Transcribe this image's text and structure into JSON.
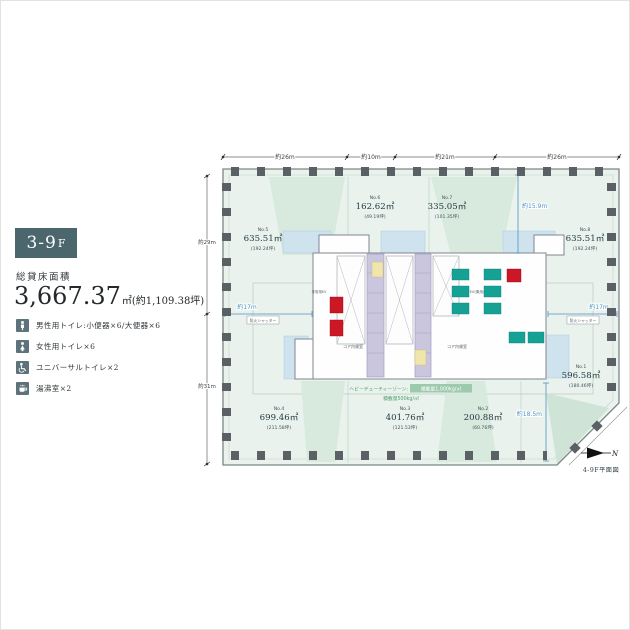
{
  "panel": {
    "floor_badge": {
      "main": "3-9",
      "suffix": "F"
    },
    "area_label": "総貸床面積",
    "area_value": "3,667.37",
    "area_unit": "㎡",
    "area_tsubo": "(約1,109.38坪)",
    "facilities": [
      {
        "icon": "male-toilet-icon",
        "label": "男性用トイレ:小便器×6/大便器×6"
      },
      {
        "icon": "female-toilet-icon",
        "label": "女性用トイレ×6"
      },
      {
        "icon": "universal-toilet-icon",
        "label": "ユニバーサルトイレ×2"
      },
      {
        "icon": "kitchenette-icon",
        "label": "湯沸室×2"
      }
    ]
  },
  "plan": {
    "caption": "4-9F平面図",
    "north": "N",
    "dims_top": [
      "約26m",
      "約10m",
      "約21m",
      "約26m"
    ],
    "dims_left": [
      "約29m",
      "約31m"
    ],
    "dim_17_left": "約17m",
    "dim_17_right": "約17m",
    "dim_159": "約15.9m",
    "dim_185": "約18.5m",
    "fire_shutter": "防火シャッター",
    "heavy_duty_label": "ヘビーデューティーゾーン:",
    "heavy_duty_value": "積載量1,000kg/㎡",
    "load_note": "積載量500kg/㎡",
    "core": {
      "lease_room": "コア内貸室",
      "ev": "EV(乗用)",
      "emergency_ev": "非常用EV"
    },
    "rooms": [
      {
        "no": "No.1",
        "area": "596.58㎡",
        "tsubo": "(180.46坪)"
      },
      {
        "no": "No.2",
        "area": "200.88㎡",
        "tsubo": "(60.76坪)"
      },
      {
        "no": "No.3",
        "area": "401.76㎡",
        "tsubo": "(121.53坪)"
      },
      {
        "no": "No.4",
        "area": "699.46㎡",
        "tsubo": "(211.58坪)"
      },
      {
        "no": "No.5",
        "area": "635.51㎡",
        "tsubo": "(192.24坪)"
      },
      {
        "no": "No.6",
        "area": "162.62㎡",
        "tsubo": "(49.19坪)"
      },
      {
        "no": "No.7",
        "area": "335.05㎡",
        "tsubo": "(101.35坪)"
      },
      {
        "no": "No.8",
        "area": "635.51㎡",
        "tsubo": "(192.24坪)"
      }
    ],
    "colors": {
      "badge": "#4c666e",
      "tenant_green": "#e9f2ec",
      "elevator_teal": "#16a195",
      "emergency_red": "#cc1726",
      "core_purple": "#cac6de",
      "dimension_blue": "#4f93c5",
      "load_green": "#4aa06c"
    }
  }
}
